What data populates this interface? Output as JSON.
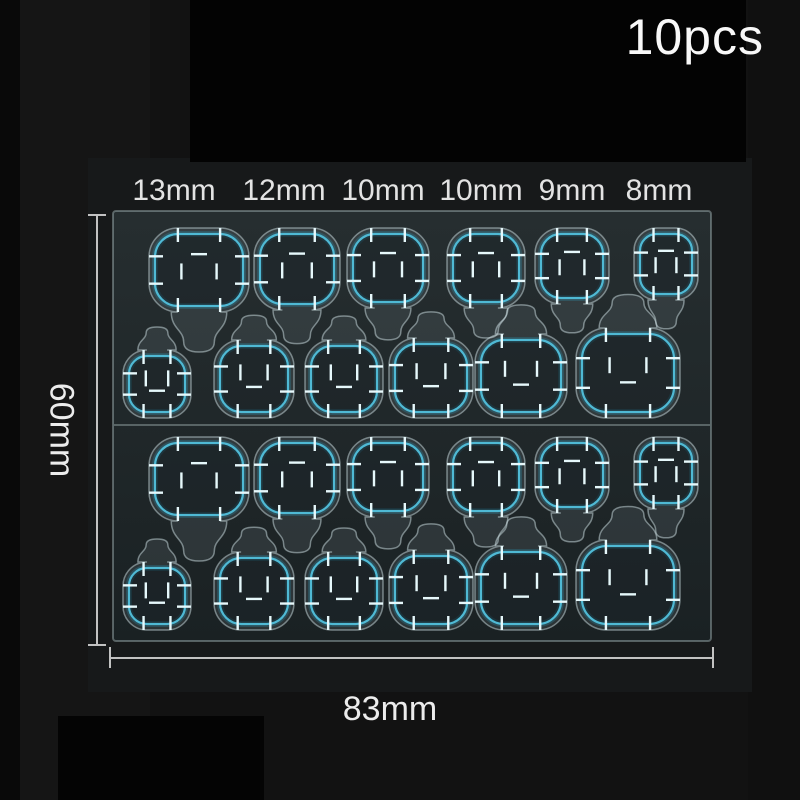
{
  "product": {
    "quantity_label": "10pcs"
  },
  "size_labels": [
    "13mm",
    "12mm",
    "10mm",
    "10mm",
    "9mm",
    "8mm"
  ],
  "dimensions": {
    "height_label": "60mm",
    "width_label": "83mm"
  },
  "sheet": {
    "x": 112,
    "y": 210,
    "w": 600,
    "h": 432,
    "divider_y": 425,
    "tab_count": 24,
    "colors": {
      "fill_top": "#262e30",
      "fill_bottom": "#1a2123",
      "edge": "rgba(185,205,208,0.40)",
      "divider": "rgba(200,218,220,0.45)",
      "die_stroke": "rgba(205,224,227,0.50)",
      "die_fill": "rgba(170,192,195,0.12)",
      "tab_fill": "rgba(4,12,16,0.42)",
      "outline": "#4fb9d4",
      "outline_glow": "#2b9cbd",
      "tick": "#e6f8fb"
    },
    "halves": [
      {
        "row_a_top": 234,
        "row_b_bottom": 412
      },
      {
        "row_a_top": 443,
        "row_b_bottom": 624
      }
    ],
    "row_a_sizes_mm": [
      13,
      12,
      10,
      10,
      9,
      8
    ],
    "row_b_sizes_mm": [
      8,
      9,
      10,
      10,
      12,
      13
    ],
    "row_a": [
      {
        "cx": 199,
        "w": 88,
        "h": 72
      },
      {
        "cx": 297,
        "w": 74,
        "h": 70
      },
      {
        "cx": 388,
        "w": 70,
        "h": 68
      },
      {
        "cx": 486,
        "w": 66,
        "h": 68
      },
      {
        "cx": 572,
        "w": 62,
        "h": 64
      },
      {
        "cx": 666,
        "w": 52,
        "h": 60
      }
    ],
    "row_b": [
      {
        "cx": 157,
        "w": 56,
        "h": 56
      },
      {
        "cx": 254,
        "w": 68,
        "h": 66
      },
      {
        "cx": 344,
        "w": 66,
        "h": 66
      },
      {
        "cx": 431,
        "w": 72,
        "h": 68
      },
      {
        "cx": 521,
        "w": 80,
        "h": 72
      },
      {
        "cx": 628,
        "w": 92,
        "h": 78
      }
    ]
  }
}
